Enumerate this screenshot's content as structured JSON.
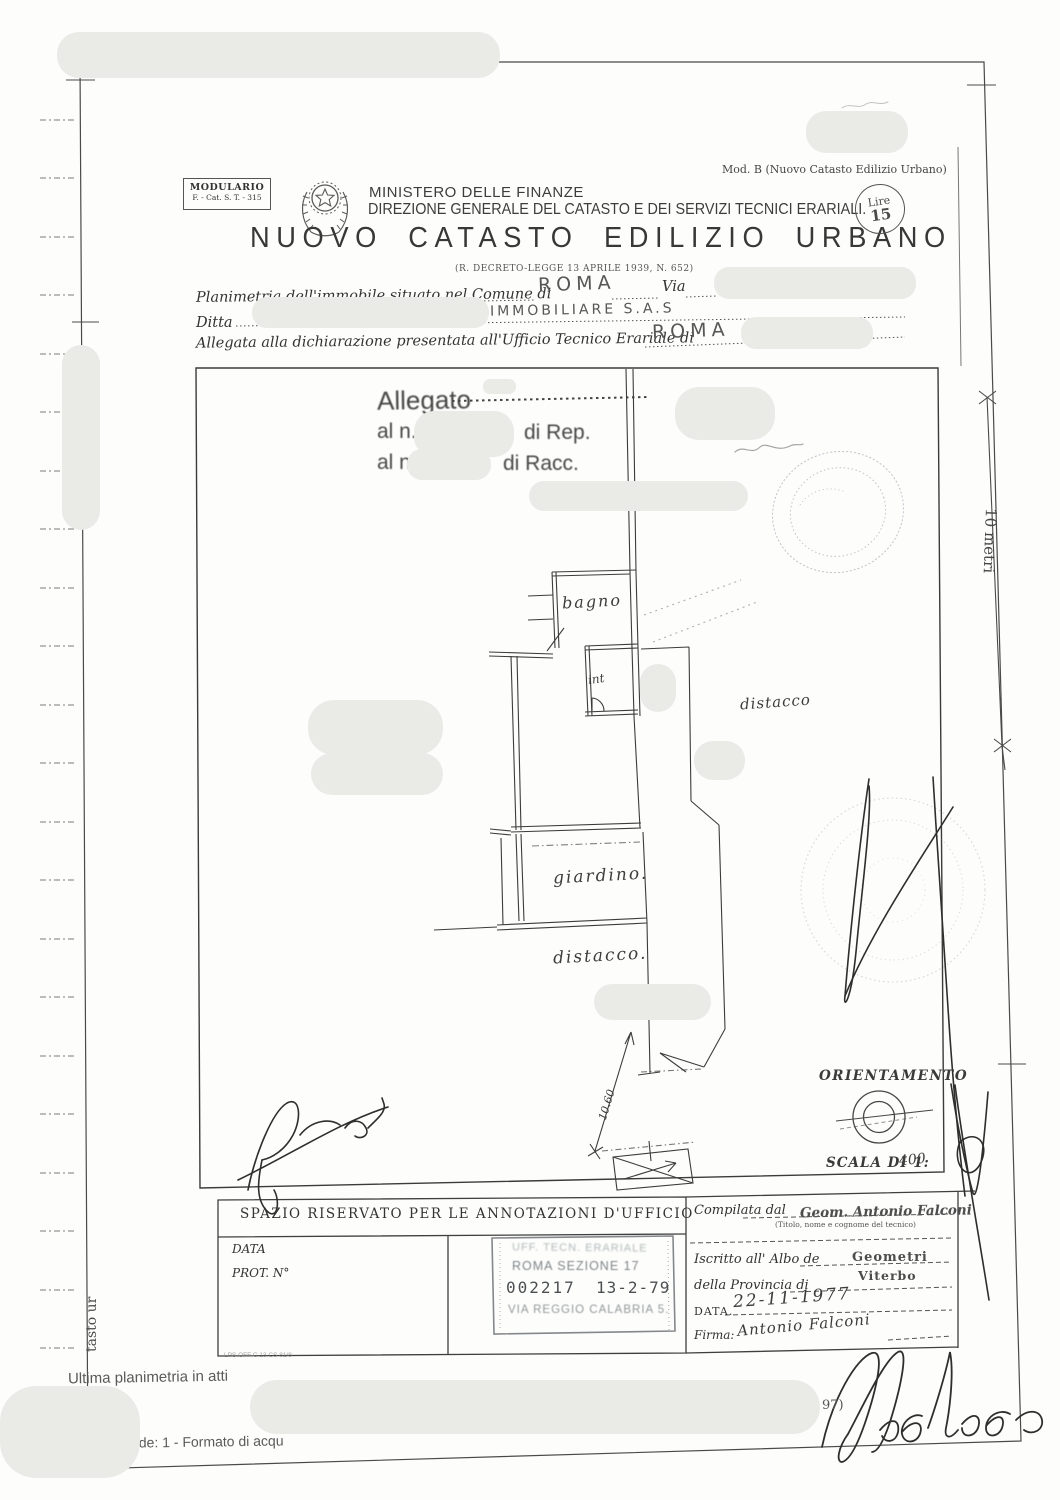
{
  "header": {
    "mod_label": "Mod. B (Nuovo Catasto Edilizio Urbano)",
    "modulario_line1": "MODULARIO",
    "modulario_line2": "F. - Cat. S. T. - 315",
    "ministry": "MINISTERO DELLE FINANZE",
    "directorate": "DIREZIONE GENERALE DEL CATASTO E DEI SERVIZI TECNICI ERARIALI.",
    "title": "NUOVO CATASTO EDILIZIO URBANO",
    "decree": "(R. DECRETO-LEGGE 13 APRILE 1939, N. 652)",
    "lire_label": "Lire",
    "lire_value": "15"
  },
  "fields": {
    "planimetria_label": "Planimetria dell'immobile situato nel Comune di",
    "comune_value": "ROMA",
    "via_label": "Via",
    "ditta_label": "Ditta",
    "ditta_value": "IMMOBILIARE  S.A.S",
    "allegata_label": "Allegata alla dichiarazione presentata all'Ufficio Tecnico Erariale di",
    "erariale_value": "ROMA"
  },
  "allegato_stamp": {
    "title": "Allegato",
    "rep_prefix": "al n.",
    "rep_suffix": "di Rep.",
    "racc_prefix": "al n.",
    "racc_suffix": "di Racc."
  },
  "plan": {
    "room_bagno": "bagno",
    "room_int": "int",
    "area_distacco_right": "distacco",
    "area_giardino": "giardino.",
    "area_distacco_bottom": "distacco.",
    "dimension": "10.60"
  },
  "orientation": {
    "title": "ORIENTAMENTO",
    "scale_label": "SCALA DI 1:",
    "scale_value": "400"
  },
  "scale_bar": {
    "label": "10 metri"
  },
  "office_box": {
    "header": "SPAZIO RISERVATO PER LE ANNOTAZIONI D'UFFICIO",
    "data_label": "DATA",
    "prot_label": "PROT. N°",
    "stamp_line1": "UFF. TECN. ERARIALE",
    "stamp_line2": "ROMA SEZIONE 17",
    "stamp_number": "002217",
    "stamp_date": "13-2-79",
    "stamp_line4": "VIA REGGIO CALABRIA 5.",
    "micro_note": "LPS OFF C 13 CS 81/8"
  },
  "surveyor_box": {
    "compilata_label": "Compilata dal",
    "titolo_note": "(Titolo, nome e cognome del tecnico)",
    "tecnico_name": "Geom. Antonio Falconi",
    "iscritto_label": "Iscritto all' Albo de",
    "albo_value": "Geometri",
    "provincia_label": "della Provincia di",
    "provincia_value": "Viterbo",
    "data_label": "DATA.",
    "data_value": "22-11-1977",
    "firma_label": "Firma:",
    "firma_value": "Antonio Falconi"
  },
  "footer": {
    "line1": "Ultima planimetria in atti",
    "line2": "Totale schede: 1 - Formato di acqu",
    "page_fragment": "97)",
    "side_fragment": "tasto ur"
  }
}
